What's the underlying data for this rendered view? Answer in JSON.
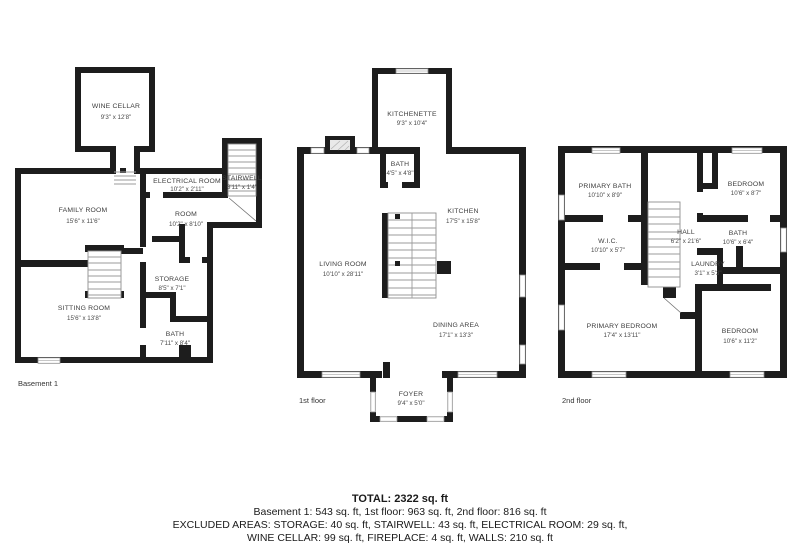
{
  "colors": {
    "wall": "#1d1d1d",
    "room_text": "#3d3d3d",
    "window_stroke": "#8f8f8f",
    "stair_stroke": "#9b9b9b",
    "background": "#ffffff"
  },
  "floors": {
    "basement": {
      "caption": "Basement 1",
      "rooms": {
        "wine_cellar": {
          "name": "WINE CELLAR",
          "dims": "9'3\" x 12'8\""
        },
        "electrical_room": {
          "name": "ELECTRICAL ROOM",
          "dims": "10'2\" x 2'11\""
        },
        "stairwell": {
          "name": "STAIRWELL",
          "dims": "3'11\" x 1'4\""
        },
        "family_room": {
          "name": "FAMILY ROOM",
          "dims": "15'6\" x 11'6\""
        },
        "room": {
          "name": "ROOM",
          "dims": "10'2\" x 8'10\""
        },
        "storage": {
          "name": "STORAGE",
          "dims": "8'5\" x 7'1\""
        },
        "sitting_room": {
          "name": "SITTING ROOM",
          "dims": "15'6\" x 13'8\""
        },
        "bath": {
          "name": "BATH",
          "dims": "7'11\" x 8'4\""
        }
      }
    },
    "first": {
      "caption": "1st floor",
      "rooms": {
        "kitchenette": {
          "name": "KITCHENETTE",
          "dims": "9'3\" x 10'4\""
        },
        "bath": {
          "name": "BATH",
          "dims": "4'5\" x 4'8\""
        },
        "kitchen": {
          "name": "KITCHEN",
          "dims": "17'5\" x 15'8\""
        },
        "living_room": {
          "name": "LIVING ROOM",
          "dims": "10'10\" x 28'11\""
        },
        "dining_area": {
          "name": "DINING AREA",
          "dims": "17'1\" x 13'3\""
        },
        "foyer": {
          "name": "FOYER",
          "dims": "9'4\" x 5'0\""
        }
      }
    },
    "second": {
      "caption": "2nd floor",
      "rooms": {
        "primary_bath": {
          "name": "PRIMARY BATH",
          "dims": "10'10\" x 8'9\""
        },
        "bedroom_top": {
          "name": "BEDROOM",
          "dims": "10'6\" x 8'7\""
        },
        "wic": {
          "name": "W.I.C.",
          "dims": "10'10\" x 5'7\""
        },
        "hall": {
          "name": "HALL",
          "dims": "6'2\" x 21'6\""
        },
        "bath": {
          "name": "BATH",
          "dims": "10'6\" x 6'4\""
        },
        "laundry": {
          "name": "LAUNDRY",
          "dims": "3'1\" x 5'3\""
        },
        "primary_bedroom": {
          "name": "PRIMARY BEDROOM",
          "dims": "17'4\" x 13'11\""
        },
        "bedroom_bottom": {
          "name": "BEDROOM",
          "dims": "10'6\" x 11'2\""
        }
      }
    }
  },
  "summary": {
    "total": "TOTAL: 2322 sq. ft",
    "floors_line": "Basement 1: 543 sq. ft, 1st floor: 963 sq. ft, 2nd floor: 816 sq. ft",
    "excluded_line1": "EXCLUDED AREAS: STORAGE: 40 sq. ft, STAIRWELL: 43 sq. ft, ELECTRICAL ROOM: 29 sq. ft,",
    "excluded_line2": "WINE CELLAR: 99 sq. ft, FIREPLACE: 4 sq. ft, WALLS: 210 sq. ft"
  }
}
